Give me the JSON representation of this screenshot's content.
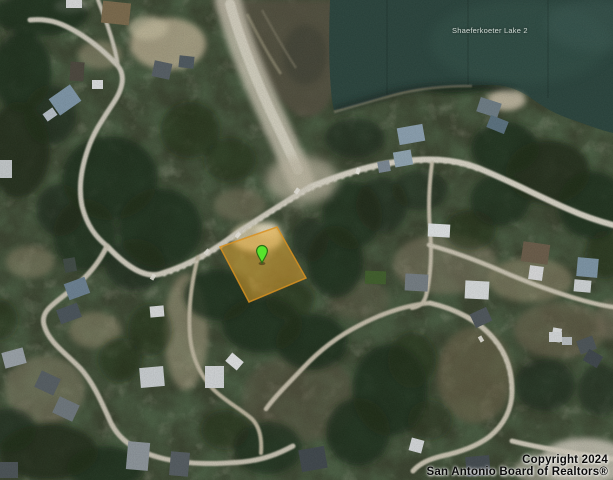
{
  "map": {
    "view_type": "satellite",
    "lake": {
      "label": "Shaeferkoeter Lake 2",
      "water_color": "#2a443d"
    },
    "parcel_highlight": {
      "points": "220,247 277,227 306,278 249,302",
      "fill": "#edab2f",
      "fill_opacity": "0.5",
      "stroke": "#d89020",
      "stroke_opacity": "0.85"
    },
    "marker": {
      "fill": "#57e42c",
      "stroke": "#2b6e14"
    },
    "copyright": {
      "line1": "Copyright 2024",
      "line2": "San Antonio Board of Realtors®"
    }
  }
}
